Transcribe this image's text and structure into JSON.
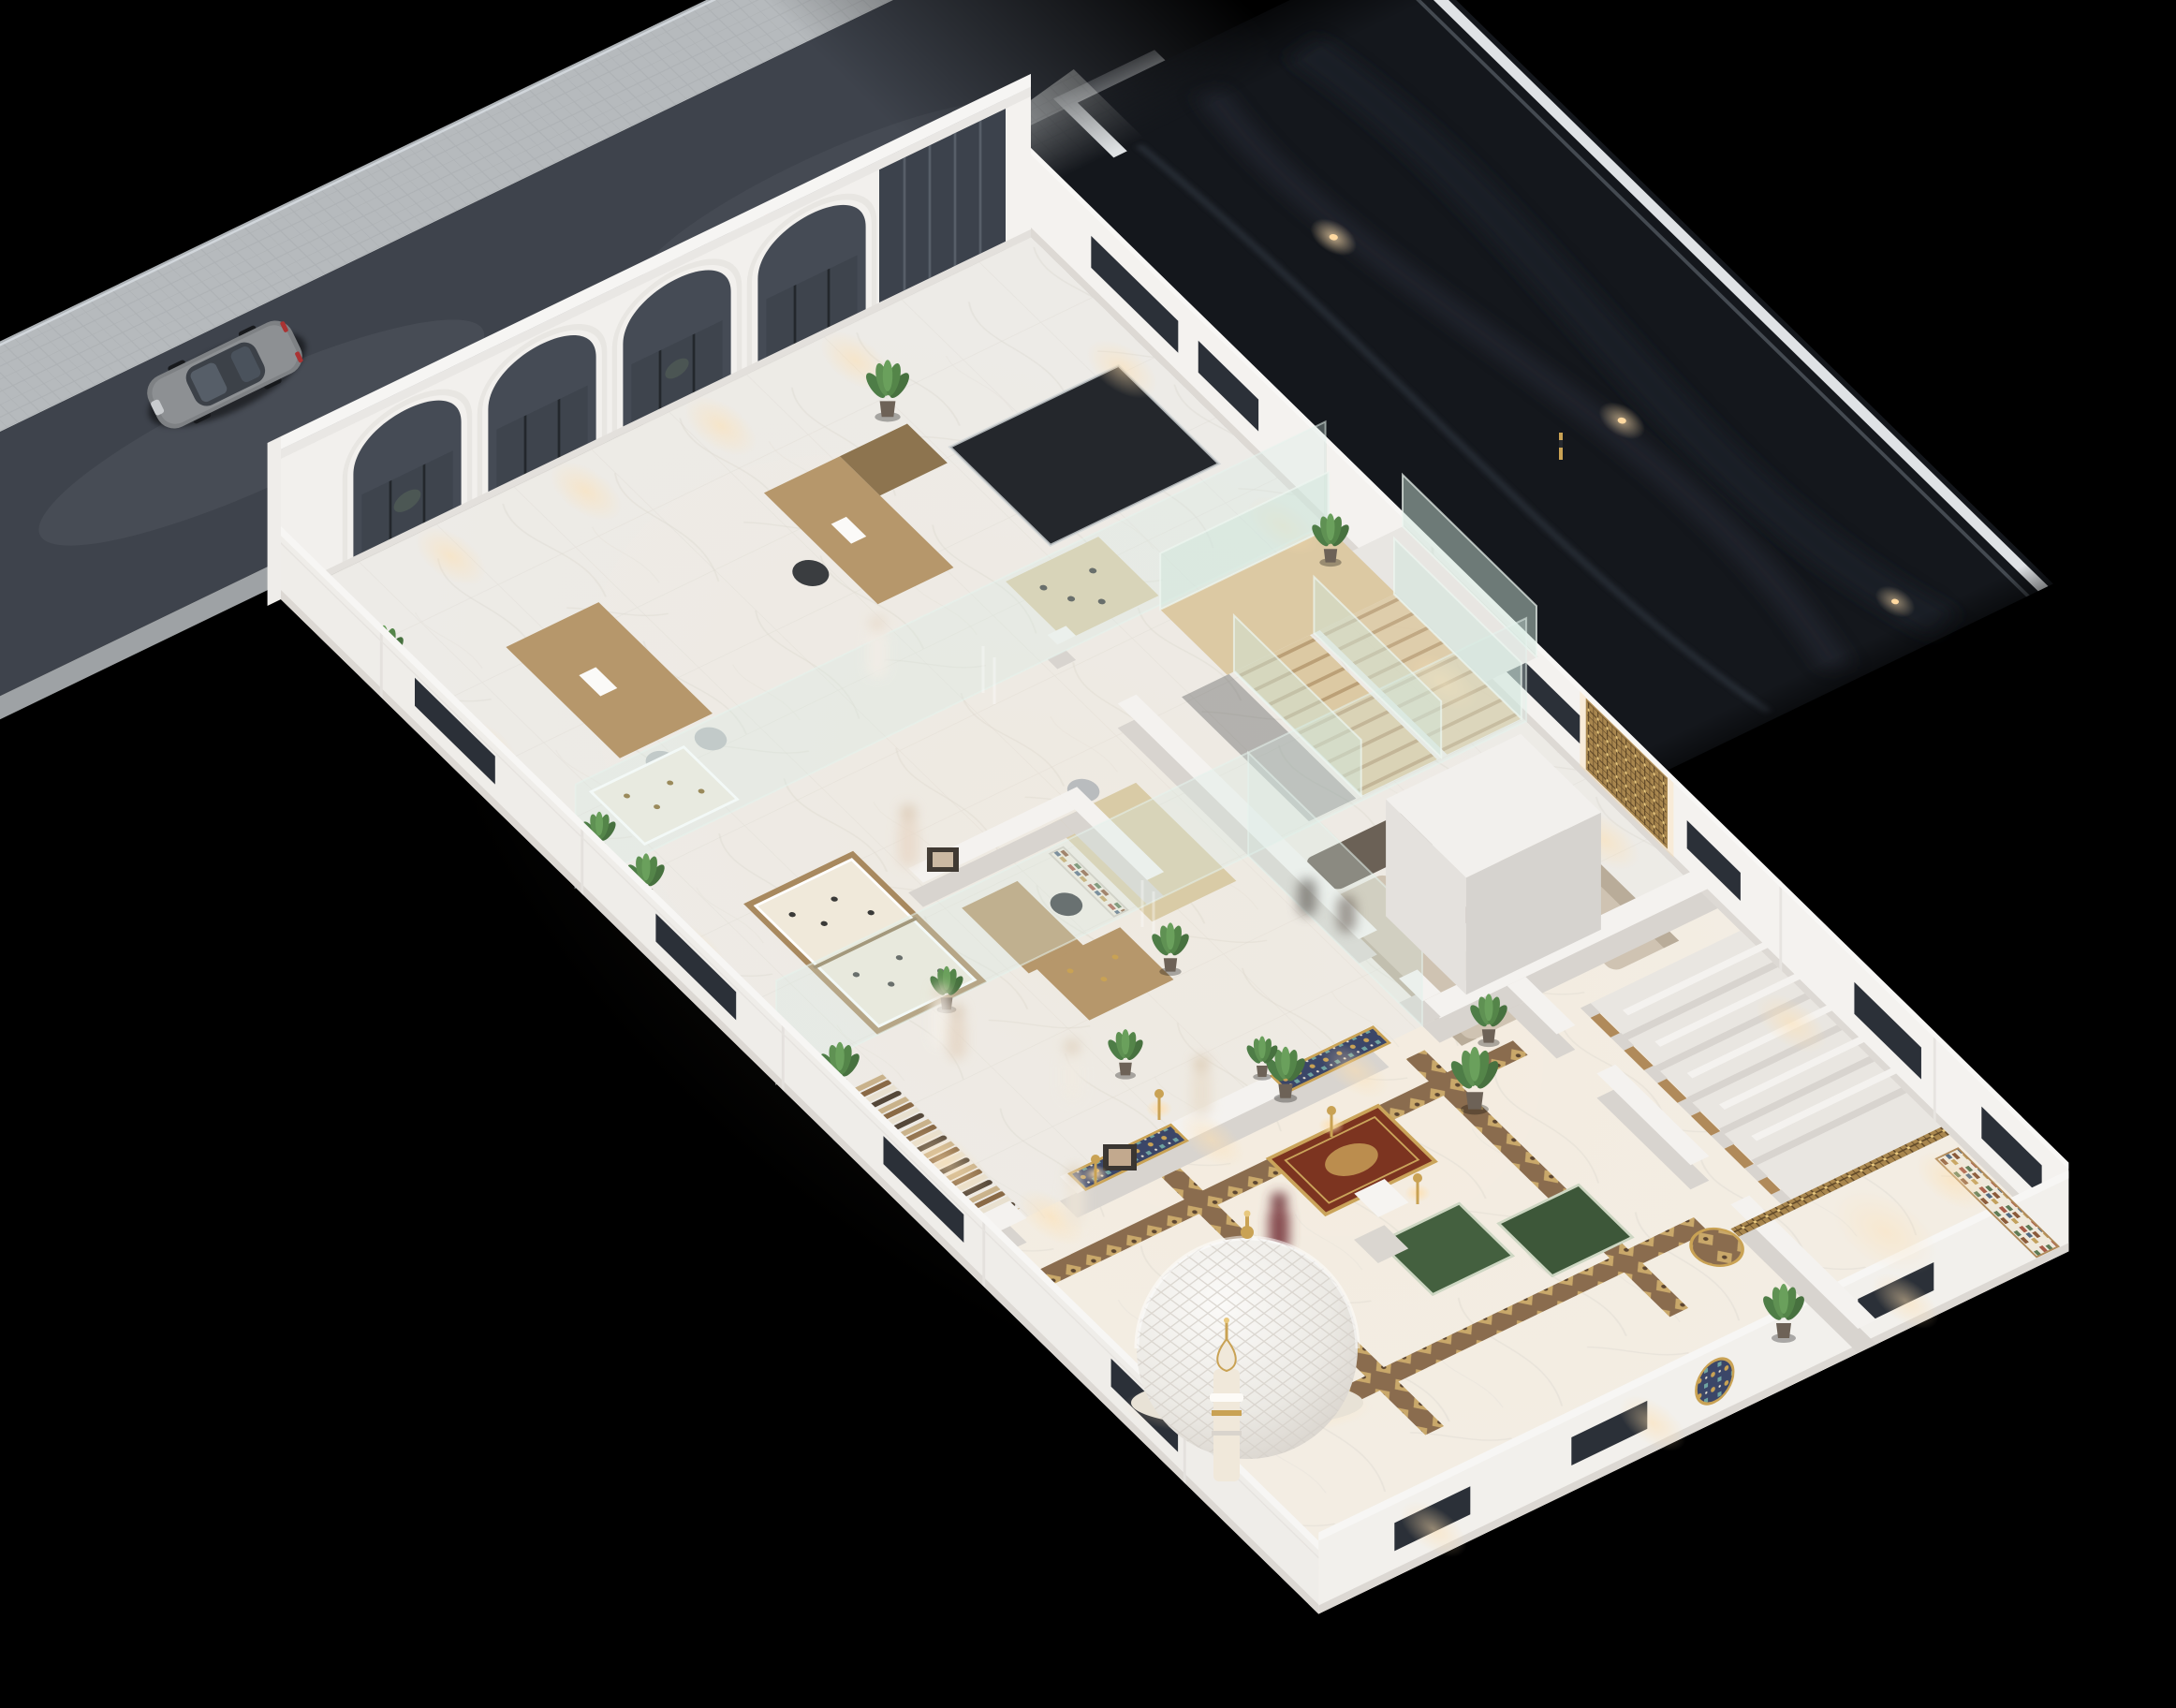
{
  "meta": {
    "scene": "isometric night cutaway render of a two-wing commercial building with Islamic prayer hall",
    "camera": "high aerial isometric",
    "lighting": "warm interior wall-wash lights against black night"
  },
  "palette": {
    "background": "#000000",
    "road": "#3e434c",
    "sidewalk": "#b7bbbe",
    "forecourt": "#b2b6b9",
    "parking": "#14171c",
    "parking_curb": "#dfe2e5",
    "building_white": "#f2f0ed",
    "wall_shadow": "#d9d5d0",
    "floor_marble": "#edebe7",
    "floor_warm": "#f3ede2",
    "glass": "#d8ece4",
    "glazing_dark": "#3c424c",
    "wood": "#b6976b",
    "stair_wood": "#dcc9a3",
    "sofa_beige": "#cfc3b2",
    "sofa_dark": "#6b6156",
    "plant_green": "#4e7d47",
    "gold": "#c9a254",
    "mosaic_navy": "#3b4668",
    "rug_red": "#7c3420",
    "rug_green": "#44603f",
    "dome_white": "#f2f0ec",
    "glow_warm": "#ffdfae",
    "car_dark": "#7e8184",
    "car_silver": "#9a9d9f"
  },
  "environment": {
    "road": {
      "surface": "dark asphalt",
      "sidewalk": "light paver band",
      "cars": [
        {
          "type": "sedan",
          "color": "#7e8184"
        },
        {
          "type": "sedan",
          "color": "#9a9d9f"
        }
      ]
    },
    "parking_lot": {
      "surface": "near-black asphalt",
      "tire_streaks": 3,
      "lights": 3,
      "curb": "white",
      "barrier_poles": 1
    }
  },
  "building": {
    "facade": {
      "arches": 4,
      "glazing": "dark glass storefront",
      "color": "#f2f0ed"
    },
    "exterior_walls": {
      "window_slits": 13,
      "style": "white parapet with moldings"
    },
    "rooms": [
      {
        "name": "reception-showroom",
        "furniture": [
          "reception desk",
          "executive desk",
          "display table",
          "jewelry vitrine",
          "potted plants"
        ]
      },
      {
        "name": "gallery",
        "furniture": [
          "double jewelry display case",
          "display table"
        ]
      },
      {
        "name": "private-office",
        "furniture": [
          "desk",
          "bookshelf",
          "wall art"
        ]
      },
      {
        "name": "staircase",
        "features": [
          "switchback wood treads",
          "glass balustrades",
          "landing"
        ]
      },
      {
        "name": "lounge",
        "furniture": [
          "two beige sofas",
          "dark accent sofa",
          "coffee table with orchid",
          "tall plants",
          "mashrabiya wall panel"
        ]
      },
      {
        "name": "boutique",
        "furniture": [
          "clothing rack with garments",
          "cashier counter",
          "wall photos"
        ]
      },
      {
        "name": "prayer-hall",
        "features": [
          "2 mosaic mihrab panels",
          "geometric gold-brown floor borders",
          "red-gold prayer rug",
          "2 green prayer rugs",
          "white column",
          "4 gold lamps",
          "wall medallion"
        ]
      },
      {
        "name": "service-corridor",
        "features": [
          "6 storage closets with wood doors",
          "wood lattice screen",
          "shelf cabinet"
        ]
      }
    ],
    "vertical_circulation": {
      "elevator_core": true,
      "atrium_void": true,
      "balcony": "glass railed, rear"
    },
    "dome": {
      "shape": "ribbed quilted hemisphere",
      "color": "#f2f0ec",
      "base_glow": "#ffdfae",
      "finial": "gold"
    },
    "minaret": {
      "color": "#f0e8da",
      "rings": "gold"
    }
  },
  "people": {
    "count": 9,
    "style": "motion-blurred translucent figures",
    "highlight": "one maroon figure in prayer hall"
  },
  "plants_total": 14
}
